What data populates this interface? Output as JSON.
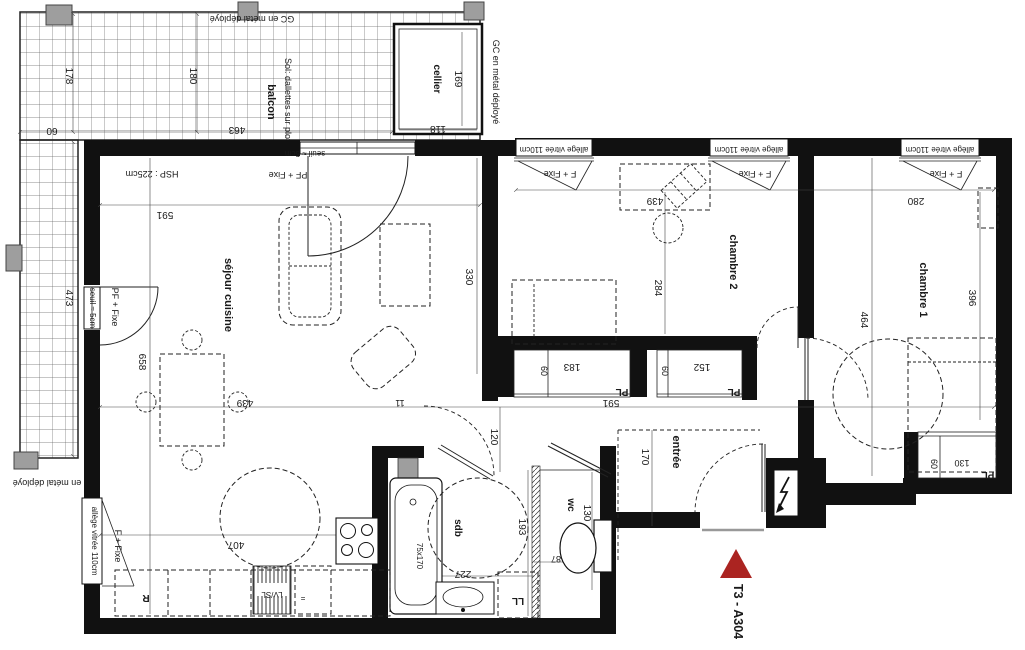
{
  "unit": {
    "label": "T3 - A304"
  },
  "colors": {
    "marker_red": "#ab2421",
    "label_red": "#8f1f1f",
    "wall_black": "#111111",
    "post_gray": "#9e9e9e"
  },
  "rooms": {
    "sejour": "séjour cuisine",
    "chambre1": "chambre 1",
    "chambre2": "chambre 2",
    "entree": "entrée",
    "sdb": "sdb",
    "wc": "wc",
    "balcon": "balcon",
    "cellier": "cellier",
    "placard": "PL",
    "refrigerateur": "R",
    "lave_vaisselle": "LV/SL",
    "lave_linge": "LL"
  },
  "labels": {
    "gc_metal": "GC en métal déployé",
    "sol_balcon": "Sol: dallettes sur plots",
    "seuil": "seuil ≈ 5cm",
    "pf_fixe": "PF + Fixe",
    "f_fixe": "F + Fixe",
    "hsp": "HSP : 225cm",
    "allege": "allège vitrée 110cm",
    "tub_size": "75x170",
    "eq_mark": "="
  },
  "dims": {
    "d11": "11",
    "d60": "60",
    "d87": "87",
    "d118": "118",
    "d120": "120",
    "d130": "130",
    "d152": "152",
    "d169": "169",
    "d170": "170",
    "d178": "178",
    "d180": "180",
    "d183": "183",
    "d193": "193",
    "d227": "227",
    "d280": "280",
    "d284": "284",
    "d330": "330",
    "d396": "396",
    "d407": "407",
    "d439": "439",
    "d463": "463",
    "d464": "464",
    "d473": "473",
    "d591": "591",
    "d658": "658"
  }
}
